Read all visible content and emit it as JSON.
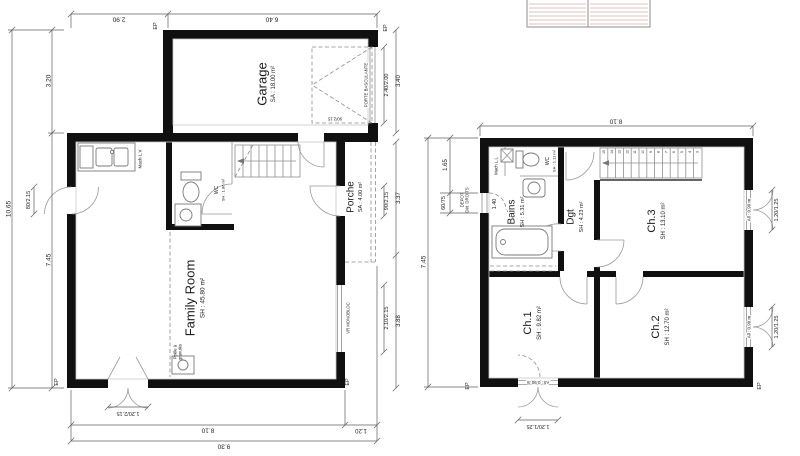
{
  "ground_floor": {
    "rooms": {
      "garage": {
        "name": "Garage",
        "area": "SA : 18.00 m²"
      },
      "porche": {
        "name": "Porche",
        "area": "SA : 4.00 m²"
      },
      "family_room": {
        "name": "Family Room",
        "area": "SH : 45.80 m²"
      },
      "wc": {
        "name": "WC",
        "area": "SH : 1.86 m²"
      }
    },
    "labels": {
      "mach_lv": "Mach L.V",
      "poele_1": "Poêle à",
      "poele_2": "granulés",
      "vr_monobloc": "VR MONOBLOC",
      "porte_basculante": "PORTE BASCULANTE",
      "garage_door": "90/2.15",
      "ep": "EP"
    },
    "dims": {
      "top_left": "2.90",
      "top_right": "6.40",
      "left_overall": "10.65",
      "left_upper": "3.20",
      "left_lower": "7.45",
      "left_door": "80/2.15",
      "garage_door": "2.40/2.00",
      "garage_height": "3.40",
      "entry_door": "90/2.15",
      "porch_height": "3.37",
      "bay_window": "2.10/2.15",
      "lower_right": "3.88",
      "bottom_door": "1.20/2.15",
      "bottom_main": "8.10",
      "bottom_porch": "1.20",
      "bottom_overall": "9.30"
    }
  },
  "first_floor": {
    "rooms": {
      "bains": {
        "name": "Bains",
        "area": "SH : 5.31 m²"
      },
      "wc": {
        "name": "WC",
        "area": "SH : 1.11 m²"
      },
      "dgt": {
        "name": "Dgt",
        "area": "SH : 4.23 m²"
      },
      "ch1": {
        "name": "Ch.1",
        "area": "SH : 9.82 m²"
      },
      "ch2": {
        "name": "Ch.2",
        "area": "SH : 12.70 m²"
      },
      "ch3": {
        "name": "Ch.3",
        "area": "SH : 13.10 m²"
      }
    },
    "labels": {
      "mach_ll": "Mach L.L",
      "depot_1": "DEPOT",
      "depot_2": "Dét. DROITS",
      "window_allege": "All : 0.90 m",
      "ep": "EP"
    },
    "dims": {
      "top": "8.10",
      "left_overall": "7.45",
      "left_upper": "1.65",
      "left_window": "60/75",
      "inner": "1.40",
      "window": "1.20/1.25"
    },
    "stairs": {
      "steps": [
        "15",
        "14",
        "13",
        "12",
        "11",
        "10",
        "9",
        "8",
        "7",
        "6",
        "5",
        "4",
        "3"
      ]
    }
  }
}
